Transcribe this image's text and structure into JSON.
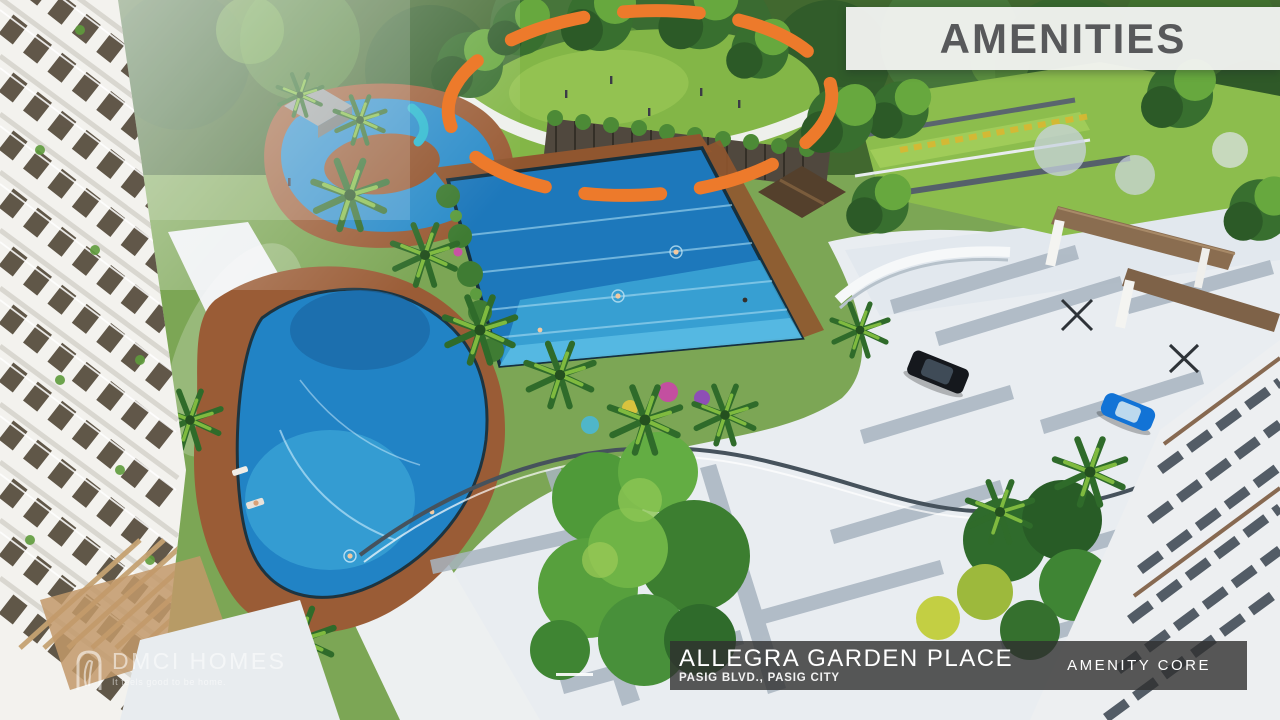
{
  "banner": {
    "label": "AMENITIES"
  },
  "highlight_ellipse": {
    "style": "dashed",
    "color": "#ED7A2B"
  },
  "info_bar": {
    "title": "ALLEGRA GARDEN PLACE",
    "subtitle": "PASIG BLVD., PASIG CITY",
    "right_label": "AMENITY CORE"
  },
  "watermark": {
    "brand": "DMCI HOMES",
    "tagline": "It feels good to be home.",
    "icon": "dmci-arch-icon"
  },
  "colors": {
    "accent_orange": "#ED7A2B",
    "banner_bg": "#F1F2F0",
    "banner_text": "#58595B",
    "info_bar_bg": "rgba(48,48,48,0.8)",
    "info_bar_text": "#FFFFFF",
    "pool_blue": "#2183C5",
    "lawn_green": "#83B647",
    "deck_brown": "#9A5C36"
  }
}
